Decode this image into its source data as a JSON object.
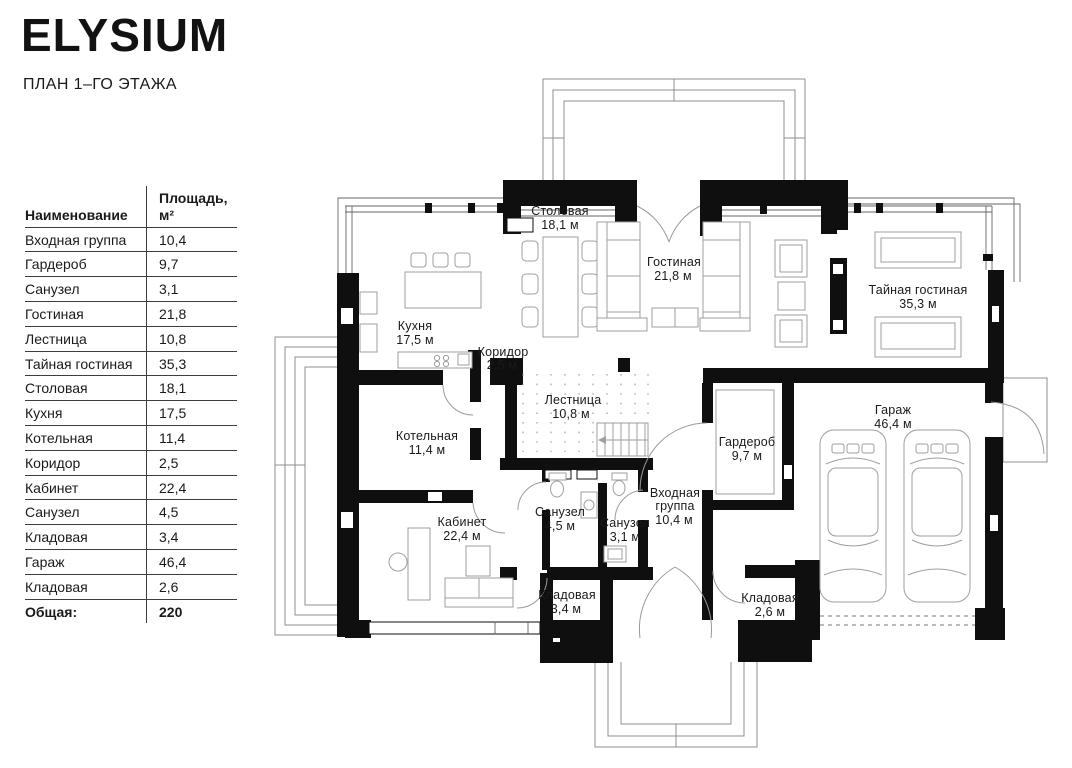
{
  "header": {
    "title": "ELYSIUM",
    "subtitle": "ПЛАН 1–ГО ЭТАЖА"
  },
  "table": {
    "headers": {
      "name": "Наименование",
      "area": "Площадь, м²"
    },
    "rows": [
      {
        "name": "Входная группа",
        "area": "10,4"
      },
      {
        "name": "Гардероб",
        "area": "9,7"
      },
      {
        "name": "Санузел",
        "area": "3,1"
      },
      {
        "name": "Гостиная",
        "area": "21,8"
      },
      {
        "name": "Лестница",
        "area": "10,8"
      },
      {
        "name": "Тайная гостиная",
        "area": "35,3"
      },
      {
        "name": "Столовая",
        "area": "18,1"
      },
      {
        "name": "Кухня",
        "area": "17,5"
      },
      {
        "name": "Котельная",
        "area": "11,4"
      },
      {
        "name": "Коридор",
        "area": "2,5"
      },
      {
        "name": "Кабинет",
        "area": "22,4"
      },
      {
        "name": "Санузел",
        "area": "4,5"
      },
      {
        "name": "Кладовая",
        "area": "3,4"
      },
      {
        "name": "Гараж",
        "area": "46,4"
      },
      {
        "name": "Кладовая",
        "area": "2,6"
      }
    ],
    "total": {
      "label": "Общая:",
      "value": "220"
    }
  },
  "plan": {
    "rooms": [
      {
        "name": "Столовая",
        "area": "18,1 м"
      },
      {
        "name": "Гостиная",
        "area": "21,8 м"
      },
      {
        "name": "Тайная гостиная",
        "area": "35,3 м"
      },
      {
        "name": "Кухня",
        "area": "17,5 м"
      },
      {
        "name": "Коридор",
        "area": "2,5 м"
      },
      {
        "name": "Лестница",
        "area": "10,8 м"
      },
      {
        "name": "Котельная",
        "area": "11,4 м"
      },
      {
        "name": "Кабинет",
        "area": "22,4 м"
      },
      {
        "name": "Санузел",
        "area": "4,5 м"
      },
      {
        "name": "Санузел",
        "area": "3,1 м"
      },
      {
        "name_lines": [
          "Входная",
          "группа"
        ],
        "area": "10,4 м"
      },
      {
        "name": "Гардероб",
        "area": "9,7 м"
      },
      {
        "name": "Кладовая",
        "area": "3,4 м"
      },
      {
        "name": "Кладовая",
        "area": "2,6 м"
      },
      {
        "name": "Гараж",
        "area": "46,4 м"
      }
    ]
  },
  "colors": {
    "wall": "#0f0f0f",
    "line": "#8f8f8f",
    "furniture": "#9f9f9f",
    "text": "#1a1a1a"
  }
}
